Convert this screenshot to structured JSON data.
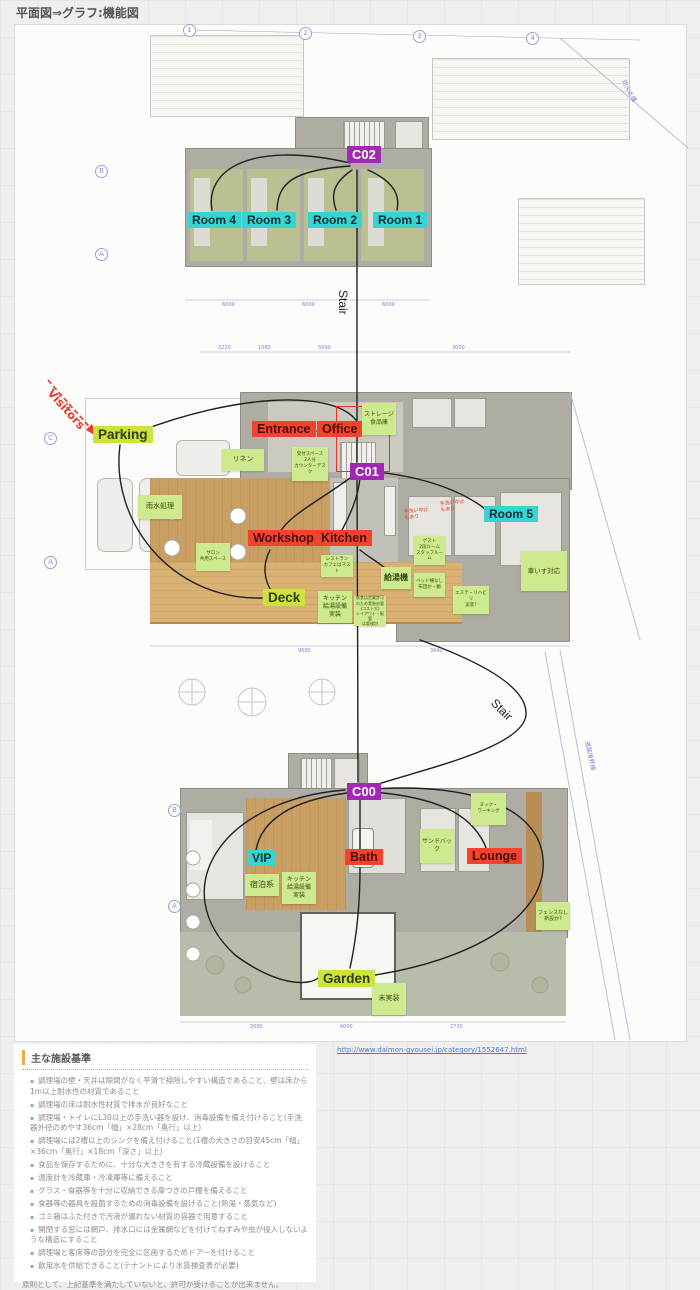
{
  "title": "平面図⇒グラフ:機能図",
  "nodes": {
    "c00": "C00",
    "c01": "C01",
    "c02": "C02",
    "room1": "Room 1",
    "room2": "Room 2",
    "room3": "Room 3",
    "room4": "Room 4",
    "room5": "Room 5",
    "entrance": "Entrance",
    "office": "Office",
    "workshop": "Workshop",
    "kitchen": "Kitchen",
    "bath": "Bath",
    "lounge": "Lounge",
    "vip": "VIP",
    "parking": "Parking",
    "deck": "Deck",
    "garden": "Garden",
    "stair_upper": "Stair",
    "stair_lower": "Stair",
    "visitors": "Visitors"
  },
  "stickies": {
    "storage": "ストレージ\n食品庫",
    "linen": "リネン",
    "rainwater": "雨水処理",
    "reception": "受付スペース\n2人分\nカウンターデスク",
    "salon": "サロン\n共用スペース",
    "restaurant": "レストラン\nカフェはマスト",
    "boiler": "給湯機",
    "kitchen_equip_mid": "キッチン\n給湯設備\n実装",
    "license_memo": "飲食店営業許可\nのため実装必要\n(コスト大)\nレイアウト・配管\nは要検討",
    "guest_room": "ゲスト\n2段ルーム\nスタッフルーム",
    "bed_note": "ベッド柵なし\n布団か・棚",
    "wheelchair": "車いす対応",
    "este": "エステ・リハビリ\n実装?",
    "lodging": "宿泊系",
    "kitchen_equip_low": "キッチン\n給湯設備\n実装",
    "sandbag": "サンドバック",
    "nook": "ヌック・\nワーキング",
    "fence": "フェンスなし\n新設か?",
    "not_impl": "未実装"
  },
  "red_notes": {
    "a": "手洗い中止\nもあり",
    "b": "手洗い中止\nもあり"
  },
  "grid_refs": {
    "n1": "1",
    "n2": "2",
    "n3": "3",
    "n4": "4",
    "b_top": "B",
    "a_top": "A",
    "c_mid": "C",
    "a_mid": "A",
    "b_low": "B",
    "a_low": "A"
  },
  "dims": {
    "t1": "6000",
    "t2": "6000",
    "t3": "6000",
    "m1": "3220",
    "m2": "1080",
    "m3": "5690",
    "m4": "3000",
    "m5": "9600",
    "m6": "3640",
    "g1": "2000",
    "g2": "6000",
    "g3": "2730"
  },
  "boundary_labels": {
    "fire": "防火水槽",
    "road": "道路境界線"
  },
  "link": {
    "url": "http://www.daimon-gyousei.jp/category/1552647.html"
  },
  "standards": {
    "heading": "主な施設基準",
    "items": [
      "調理場の壁・天井は隙間がなく平滑で掃除しやすい構造であること、壁は床から1m以上耐水性の材質であること",
      "調理場の床は耐水性材質で排水が良好なこと",
      "調理場・トイレにL30以上の手洗い器を設け、消毒設備を備え付けること(手洗器外径のめやす36cm「幅」×28cm「奥行」以上)",
      "調理場には2槽以上のシンクを備え付けること(1槽の大きさの目安45cm「幅」×36cm「奥行」×18cm「深さ」以上)",
      "食品を保存するために、十分な大きさを有する冷蔵設備を設けること",
      "温度計を冷蔵庫・冷凍庫等に備えること",
      "グラス・食器等を十分に収納できる扉つきの戸棚を備えること",
      "食器等の器具を殺菌するための消毒設備を設けること(熱湯・蒸気など)",
      "ゴミ箱はふた付きで汚液が漏れない材質の容器で用意すること",
      "開閉する窓には網戸、排水口には金属網などを付けてねずみや虫が侵入しないような構造にすること",
      "調理場と客席等の部分を完全に区画するためドアーを付けること",
      "飲用水を供給できること(テナントにより水質検査表が必要)"
    ],
    "footer": "原則として、上記基準を満たしていないと、許可が受けることが出来ません。"
  }
}
